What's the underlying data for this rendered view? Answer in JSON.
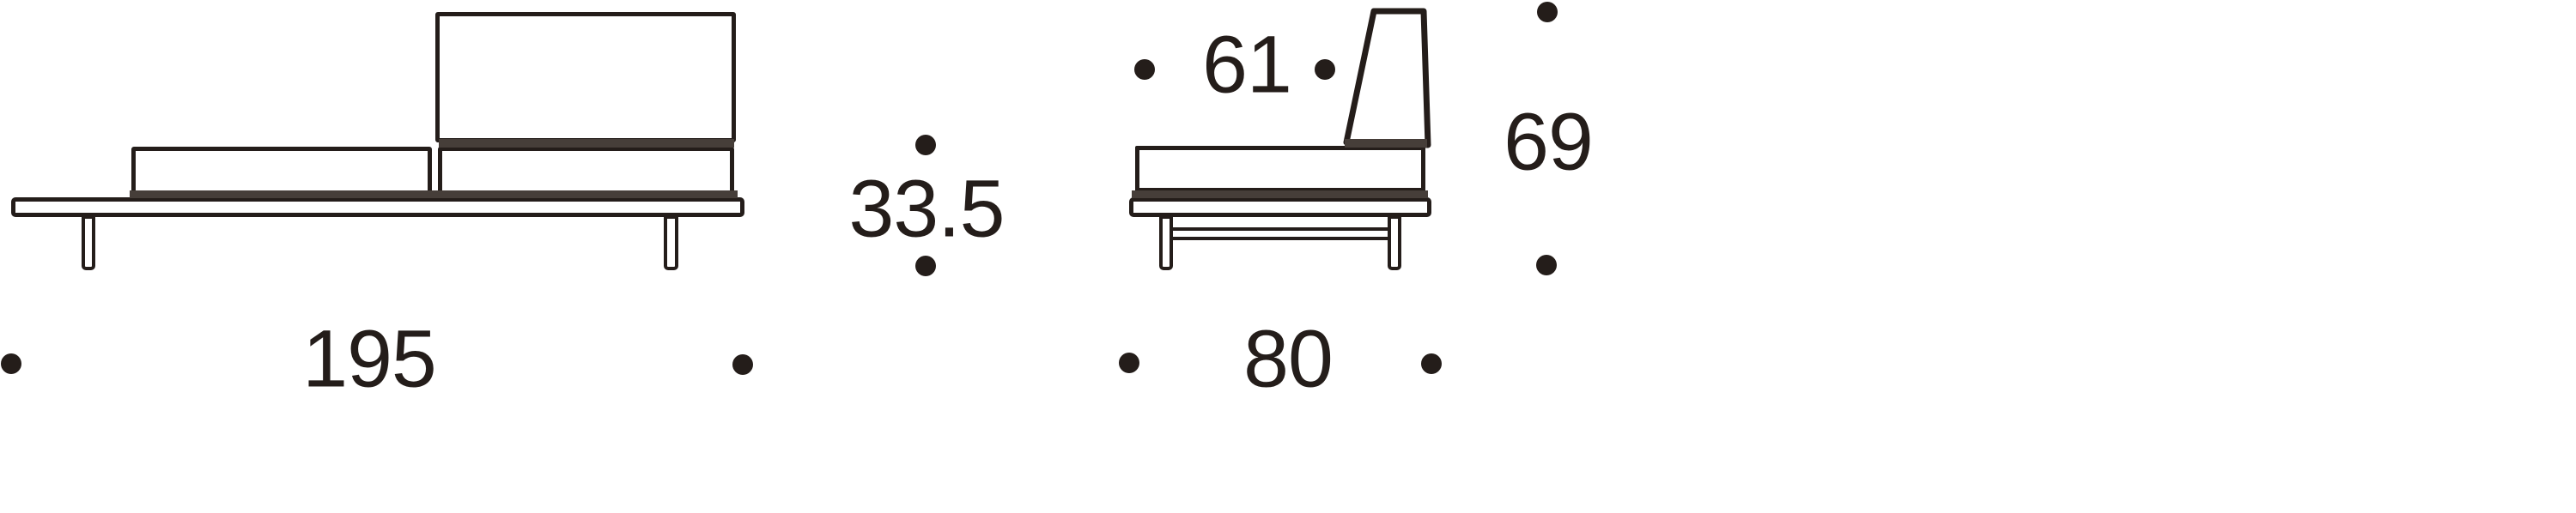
{
  "diagram": {
    "type": "furniture-dimension-diagram",
    "views": {
      "side": {
        "name": "sofa side view",
        "dimensions": {
          "overall_width": {
            "label": "195",
            "orientation": "horizontal"
          },
          "seat_height": {
            "label": "33.5",
            "orientation": "vertical"
          }
        }
      },
      "end": {
        "name": "sofa end view",
        "dimensions": {
          "backrest_depth": {
            "label": "61",
            "orientation": "horizontal"
          },
          "overall_height": {
            "label": "69",
            "orientation": "vertical"
          },
          "overall_depth": {
            "label": "80",
            "orientation": "horizontal"
          }
        }
      }
    },
    "colors": {
      "ink": "#241d1a",
      "band": "#463e39",
      "background": "#ffffff"
    }
  }
}
